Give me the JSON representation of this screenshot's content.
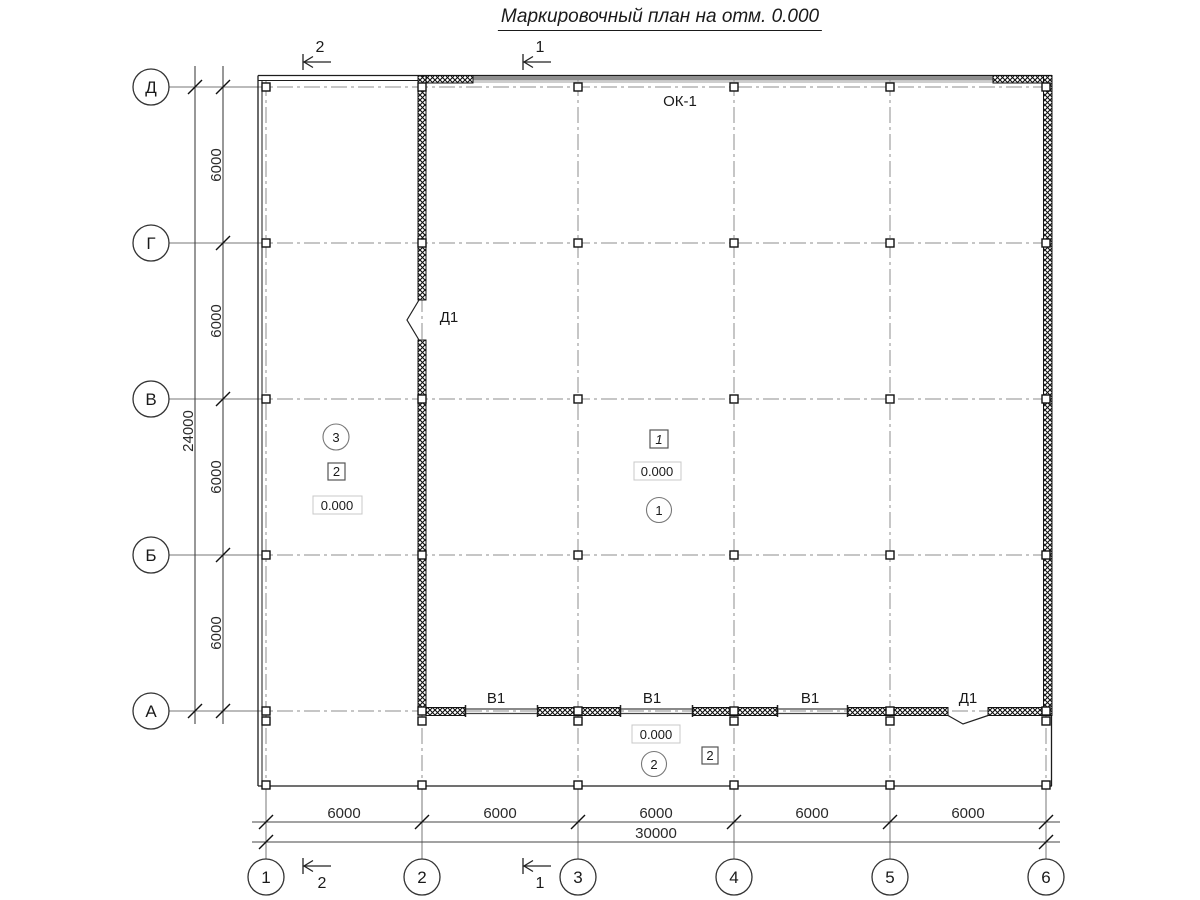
{
  "title": "Маркировочный план на отм. 0.000",
  "axes": {
    "rows": [
      "Д",
      "Г",
      "В",
      "Б",
      "А"
    ],
    "cols": [
      "1",
      "2",
      "3",
      "4",
      "5",
      "6"
    ]
  },
  "dimensions": {
    "left_bay": "6000",
    "left_total": "24000",
    "bottom_bay": "6000",
    "bottom_total": "30000"
  },
  "sections": {
    "s1": "1",
    "s2": "2"
  },
  "openings": {
    "window_top": "ОК-1",
    "window_bottom": "В1",
    "door": "Д1"
  },
  "rooms": {
    "hall": {
      "number": "1",
      "mark": "1",
      "elevation": "0.000"
    },
    "left": {
      "number": "3",
      "mark": "2",
      "elevation": "0.000"
    },
    "bottom": {
      "number": "2",
      "mark": "2",
      "elevation": "0.000"
    }
  }
}
